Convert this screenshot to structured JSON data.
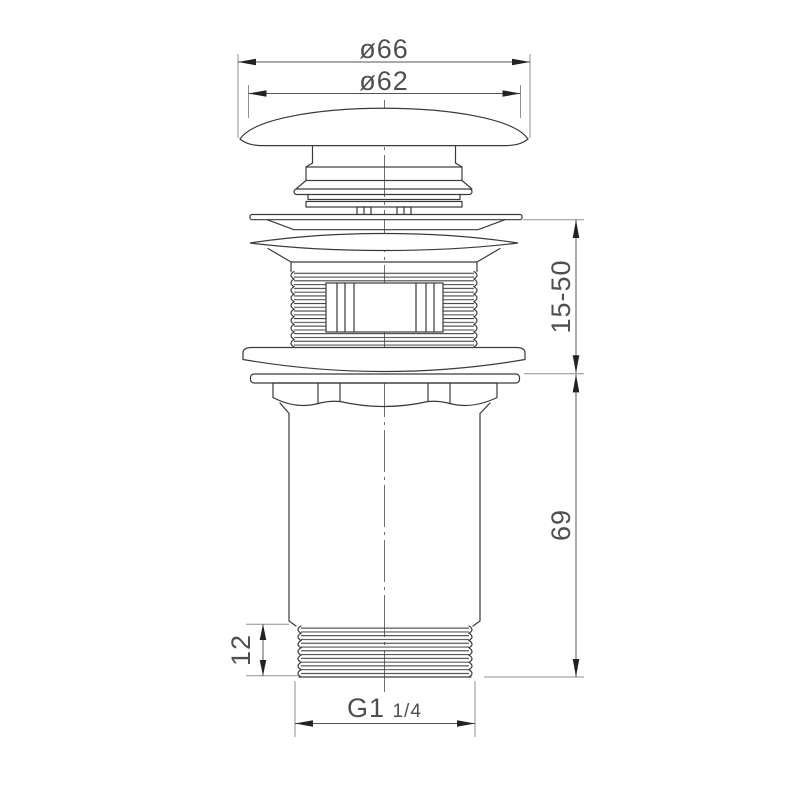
{
  "drawing": {
    "type": "technical-drawing",
    "subject": "pop-up-basin-waste-drain",
    "dimensions": {
      "cap_outer_diameter": "ø66",
      "cap_face_diameter": "ø62",
      "clamp_range": "15-50",
      "tail_length": "69",
      "lower_thread_length": "12",
      "connection_thread_prefix": "G1",
      "connection_thread_fraction": "1/4"
    },
    "colors": {
      "background": "#ffffff",
      "outline": "#3a3a3a",
      "dimension_line": "#555555",
      "extension_line": "#8f8f8f",
      "text": "#4f4f4f"
    }
  }
}
